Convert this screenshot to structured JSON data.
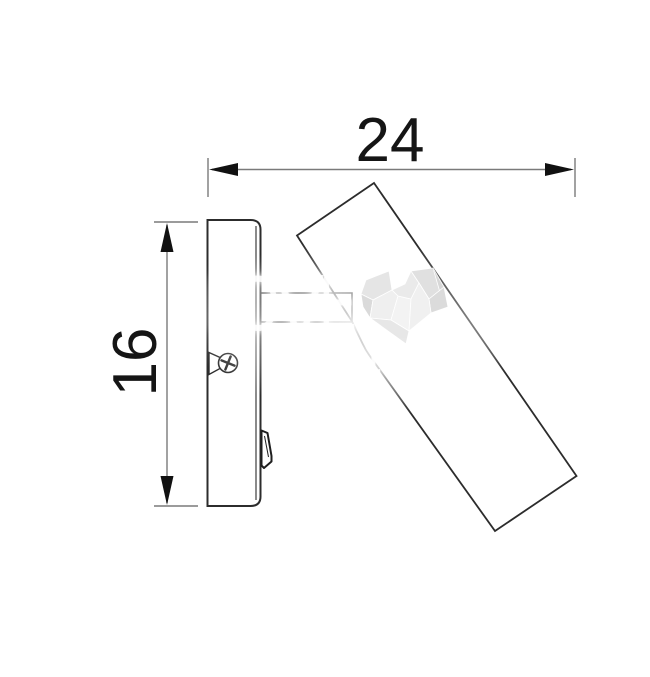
{
  "diagram": {
    "title": "wall-mounted adjustable spotlight side-view technical drawing",
    "dimensions": {
      "width": {
        "label": "24"
      },
      "height": {
        "label": "16"
      }
    },
    "colors": {
      "outline": "#2c2c2c",
      "dimension_line": "#7a7a7a",
      "arrow": "#111111",
      "label_text": "#151515"
    }
  },
  "watermark": {
    "brand_lo": "LO",
    "brand_v": "V",
    "brand_e": "E",
    "tagline": "lighting",
    "text_color": "#ffffff",
    "heart_shades": [
      "#d4d4d4",
      "#dedede",
      "#e6e6e6",
      "#efefef",
      "#f3f3f3"
    ]
  }
}
